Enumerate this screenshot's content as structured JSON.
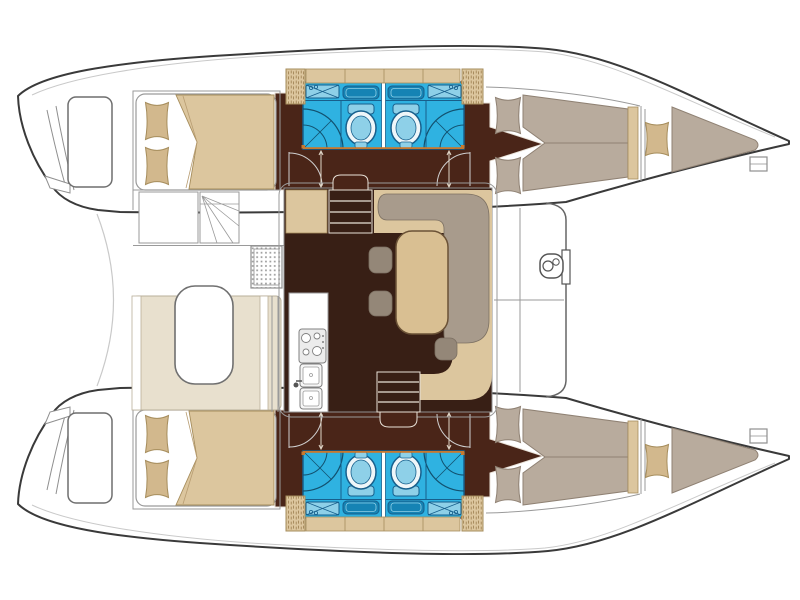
{
  "meta": {
    "type": "boat-floor-plan",
    "subject": "Sailing catamaran accommodation layout, top view",
    "orientation": "bows to the right, sterns with swim platforms to the left"
  },
  "counts": {
    "double_cabins": 4,
    "bathrooms": 4,
    "forepeak_berths": 2,
    "salon_tables": 1,
    "cockpit_tables": 1,
    "companionway_steps": 2
  },
  "areas": {
    "hull_top": "Upper hull: aft double cabin, twin bathrooms, forward double cabin, forepeak berth",
    "hull_bottom": "Lower hull: aft double cabin, twin bathrooms, forward double cabin, forepeak berth",
    "aft_cabin": "Aft double cabin with pillows and duvet",
    "bathroom": "Bathroom with washbasin, toilet and shower",
    "forward_cabin": "Forward double cabin",
    "forepeak": "Forepeak berth",
    "salon": "Salon with L-shaped sofa, dining table and stools",
    "galley": "Galley with stove and twin sinks",
    "cockpit": "Aft cockpit with table and bench seating",
    "helm": "Helm area with access steps",
    "foredeck": "Foredeck with anchor windlass",
    "transom": "Transom swim platform with steps",
    "steps": "Companionway steps down into hull",
    "trampoline": "Open bow area between hulls"
  },
  "palette": {
    "white": "#ffffff",
    "outline": "#3a3a3a",
    "line": "#9a9a9a",
    "line_light": "#c9c9c9",
    "tan": "#dcc69e",
    "tan_stroke": "#a68d5c",
    "pillow": "#d2b88d",
    "taupe": "#b8ab9d",
    "taupe_stroke": "#8f8173",
    "sofa": "#a89b8c",
    "sofa_stroke": "#7c7062",
    "stool": "#948778",
    "floor": "#381f15",
    "corridor": "#4a2518",
    "corridor_rim": "#e9e2d8",
    "bench": "#e8e0ce",
    "bench_stroke": "#b9af99",
    "blue": "#2fb2e1",
    "blue_line": "#175f8c",
    "blue_mid": "#1583b4",
    "blue_pale": "#8ed0e8",
    "toilet": "#eef6f9",
    "orange": "#c8792f",
    "steel": "#666666"
  }
}
